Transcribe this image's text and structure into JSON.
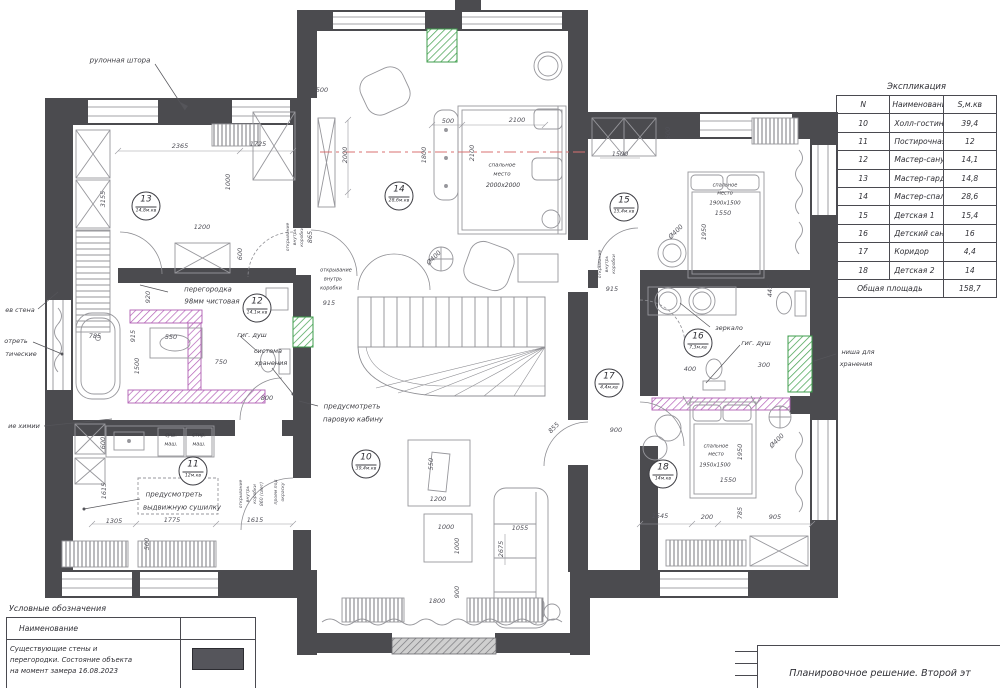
{
  "explication": {
    "title": "Экспликация",
    "headers": {
      "n": "N",
      "name": "Наименование",
      "area": "S,м.кв"
    },
    "rows": [
      {
        "n": "10",
        "name": "Холл-гостиная",
        "area": "39,4"
      },
      {
        "n": "11",
        "name": "Постирочная",
        "area": "12"
      },
      {
        "n": "12",
        "name": "Мастер-санузел",
        "area": "14,1"
      },
      {
        "n": "13",
        "name": "Мастер-гардероб",
        "area": "14,8"
      },
      {
        "n": "14",
        "name": "Мастер-спальня",
        "area": "28,6"
      },
      {
        "n": "15",
        "name": "Детская 1",
        "area": "15,4"
      },
      {
        "n": "16",
        "name": "Детский санузел",
        "area": "16"
      },
      {
        "n": "17",
        "name": "Коридор",
        "area": "4,4"
      },
      {
        "n": "18",
        "name": "Детская 2",
        "area": "14"
      }
    ],
    "total_label": "Общая площадь",
    "total_value": "158,7"
  },
  "legend": {
    "title": "Условные обозначения",
    "header": "Наименование",
    "row_lines": [
      "Существующие стены и",
      "перегородки. Состояние объекта",
      "на момент замера 16.08.2023"
    ]
  },
  "titleblock": {
    "title": "Планировочное решение. Второй эт"
  },
  "plan": {
    "room_badges": [
      {
        "num": "13",
        "area": "14,8м.кв",
        "x": 146,
        "y": 206
      },
      {
        "num": "12",
        "area": "14,1м.кв",
        "x": 257,
        "y": 308
      },
      {
        "num": "14",
        "area": "28,6м.кв",
        "x": 399,
        "y": 196
      },
      {
        "num": "15",
        "area": "15,4м.кв",
        "x": 624,
        "y": 207
      },
      {
        "num": "16",
        "area": "7,3м.кв",
        "x": 698,
        "y": 343
      },
      {
        "num": "17",
        "area": "4,4м.кв",
        "x": 609,
        "y": 383
      },
      {
        "num": "11",
        "area": "12м.кв",
        "x": 193,
        "y": 471
      },
      {
        "num": "10",
        "area": "39,4м.кв",
        "x": 366,
        "y": 464
      },
      {
        "num": "18",
        "area": "14м.кв",
        "x": 663,
        "y": 474
      }
    ],
    "labels": [
      {
        "t": "рулонная штора",
        "x": 120,
        "y": 61,
        "s": 7
      },
      {
        "t": "перегородка",
        "x": 208,
        "y": 290,
        "s": 7
      },
      {
        "t": "98мм чистовая",
        "x": 212,
        "y": 302,
        "s": 7
      },
      {
        "t": "гиг. душ",
        "x": 252,
        "y": 335
      },
      {
        "t": "система",
        "x": 268,
        "y": 351
      },
      {
        "t": "хранения",
        "x": 271,
        "y": 363
      },
      {
        "t": "предусмотреть",
        "x": 352,
        "y": 407,
        "s": 7
      },
      {
        "t": "паровую кабину",
        "x": 353,
        "y": 420,
        "s": 7
      },
      {
        "t": "предусмотреть",
        "x": 174,
        "y": 495,
        "s": 7
      },
      {
        "t": "выдвижную сушилку",
        "x": 182,
        "y": 508,
        "s": 7
      },
      {
        "t": "зеркало",
        "x": 729,
        "y": 328
      },
      {
        "t": "гиг. душ",
        "x": 756,
        "y": 343
      },
      {
        "t": "ниша для",
        "x": 858,
        "y": 352
      },
      {
        "t": "хранения",
        "x": 856,
        "y": 364
      },
      {
        "t": "ев стена",
        "x": 20,
        "y": 310
      },
      {
        "t": "отреть",
        "x": 16,
        "y": 341
      },
      {
        "t": "тические",
        "x": 21,
        "y": 354
      },
      {
        "t": "ие химии",
        "x": 24,
        "y": 426
      },
      {
        "t": "суш.",
        "x": 171,
        "y": 436,
        "s": 5
      },
      {
        "t": "маш.",
        "x": 171,
        "y": 445,
        "s": 5
      },
      {
        "t": "стир.",
        "x": 199,
        "y": 436,
        "s": 5
      },
      {
        "t": "маш.",
        "x": 199,
        "y": 445,
        "s": 5
      },
      {
        "t": "спальное",
        "x": 502,
        "y": 166,
        "s": 5.5
      },
      {
        "t": "место",
        "x": 502,
        "y": 175,
        "s": 5.5
      },
      {
        "t": "2000х2000",
        "x": 503,
        "y": 186,
        "s": 6
      },
      {
        "t": "спальное",
        "x": 725,
        "y": 186,
        "s": 5
      },
      {
        "t": "место",
        "x": 725,
        "y": 194,
        "s": 5
      },
      {
        "t": "1900х1500",
        "x": 725,
        "y": 204,
        "s": 5.5
      },
      {
        "t": "спальное",
        "x": 716,
        "y": 447,
        "s": 5
      },
      {
        "t": "место",
        "x": 716,
        "y": 455,
        "s": 5
      },
      {
        "t": "1950х1500",
        "x": 715,
        "y": 466,
        "s": 5.5
      },
      {
        "t": "открывание",
        "x": 336,
        "y": 271,
        "s": 5
      },
      {
        "t": "внутрь",
        "x": 333,
        "y": 280,
        "s": 5
      },
      {
        "t": "коробки",
        "x": 331,
        "y": 289,
        "s": 5
      }
    ],
    "dims": [
      {
        "t": "2365",
        "x": 180,
        "y": 146
      },
      {
        "t": "1725",
        "x": 258,
        "y": 144
      },
      {
        "t": "1000",
        "x": 228,
        "y": 182,
        "r": -90
      },
      {
        "t": "3155",
        "x": 103,
        "y": 199,
        "r": -90
      },
      {
        "t": "1200",
        "x": 202,
        "y": 227
      },
      {
        "t": "600",
        "x": 240,
        "y": 254,
        "r": -90
      },
      {
        "t": "920",
        "x": 148,
        "y": 297,
        "r": -90
      },
      {
        "t": "915",
        "x": 133,
        "y": 336,
        "r": -90
      },
      {
        "t": "550",
        "x": 171,
        "y": 337
      },
      {
        "t": "1500",
        "x": 137,
        "y": 366,
        "r": -90
      },
      {
        "t": "785",
        "x": 95,
        "y": 336
      },
      {
        "t": "750",
        "x": 221,
        "y": 362
      },
      {
        "t": "800",
        "x": 267,
        "y": 398
      },
      {
        "t": "600",
        "x": 103,
        "y": 443,
        "r": -90
      },
      {
        "t": "1615",
        "x": 104,
        "y": 491,
        "r": -90
      },
      {
        "t": "1305",
        "x": 114,
        "y": 521
      },
      {
        "t": "1775",
        "x": 172,
        "y": 520
      },
      {
        "t": "1615",
        "x": 255,
        "y": 520
      },
      {
        "t": "500",
        "x": 147,
        "y": 544,
        "r": -90
      },
      {
        "t": "500",
        "x": 322,
        "y": 90
      },
      {
        "t": "2000",
        "x": 345,
        "y": 155,
        "r": -90
      },
      {
        "t": "500",
        "x": 448,
        "y": 121
      },
      {
        "t": "2100",
        "x": 517,
        "y": 120
      },
      {
        "t": "1800",
        "x": 424,
        "y": 155,
        "r": -90
      },
      {
        "t": "2100",
        "x": 472,
        "y": 153,
        "r": -90
      },
      {
        "t": "Ø400",
        "x": 434,
        "y": 258,
        "r": -45
      },
      {
        "t": "915",
        "x": 329,
        "y": 303
      },
      {
        "t": "865",
        "x": 310,
        "y": 237,
        "r": -90
      },
      {
        "t": "1500",
        "x": 620,
        "y": 154
      },
      {
        "t": "600",
        "x": 668,
        "y": 133,
        "r": -90
      },
      {
        "t": "1550",
        "x": 723,
        "y": 213
      },
      {
        "t": "1950",
        "x": 704,
        "y": 232,
        "r": -90
      },
      {
        "t": "Ø400",
        "x": 676,
        "y": 232,
        "r": -45
      },
      {
        "t": "445",
        "x": 770,
        "y": 291,
        "r": -90
      },
      {
        "t": "400",
        "x": 690,
        "y": 369
      },
      {
        "t": "300",
        "x": 764,
        "y": 365
      },
      {
        "t": "900",
        "x": 616,
        "y": 430
      },
      {
        "t": "915",
        "x": 612,
        "y": 289
      },
      {
        "t": "855",
        "x": 554,
        "y": 428,
        "r": -45
      },
      {
        "t": "1950",
        "x": 740,
        "y": 452,
        "r": -90
      },
      {
        "t": "Ø400",
        "x": 777,
        "y": 441,
        "r": -45
      },
      {
        "t": "785",
        "x": 740,
        "y": 513,
        "r": -90
      },
      {
        "t": "1545",
        "x": 660,
        "y": 516
      },
      {
        "t": "200",
        "x": 707,
        "y": 517
      },
      {
        "t": "905",
        "x": 775,
        "y": 517
      },
      {
        "t": "1550",
        "x": 728,
        "y": 480
      },
      {
        "t": "1200",
        "x": 438,
        "y": 499
      },
      {
        "t": "550",
        "x": 431,
        "y": 464,
        "r": -90
      },
      {
        "t": "1000",
        "x": 446,
        "y": 527
      },
      {
        "t": "1000",
        "x": 457,
        "y": 546,
        "r": -90
      },
      {
        "t": "2675",
        "x": 501,
        "y": 549,
        "r": -90
      },
      {
        "t": "1055",
        "x": 520,
        "y": 528
      },
      {
        "t": "1800",
        "x": 437,
        "y": 601
      },
      {
        "t": "900",
        "x": 457,
        "y": 592,
        "r": -90
      },
      {
        "t": "открывание",
        "x": 289,
        "y": 237,
        "r": -90,
        "s": 4.5
      },
      {
        "t": "внутрь",
        "x": 296,
        "y": 237,
        "r": -90,
        "s": 4.5
      },
      {
        "t": "коробки",
        "x": 303,
        "y": 237,
        "r": -90,
        "s": 4.5
      },
      {
        "t": "открывание",
        "x": 601,
        "y": 264,
        "r": -90,
        "s": 4.5
      },
      {
        "t": "внутрь",
        "x": 608,
        "y": 264,
        "r": -90,
        "s": 4.5
      },
      {
        "t": "коробки",
        "x": 615,
        "y": 264,
        "r": -90,
        "s": 4.5
      },
      {
        "t": "открывание",
        "x": 242,
        "y": 494,
        "r": -90,
        "s": 4.5
      },
      {
        "t": "внутрь",
        "x": 249,
        "y": 494,
        "r": -90,
        "s": 4.5
      },
      {
        "t": "коробки",
        "x": 256,
        "y": 494,
        "r": -90,
        "s": 4.5
      },
      {
        "t": "860 (свет)",
        "x": 263,
        "y": 494,
        "r": -90,
        "s": 4.5
      },
      {
        "t": "проем под",
        "x": 277,
        "y": 492,
        "r": -90,
        "s": 4.5
      },
      {
        "t": "окраску",
        "x": 284,
        "y": 492,
        "r": -90,
        "s": 4.5
      }
    ]
  }
}
